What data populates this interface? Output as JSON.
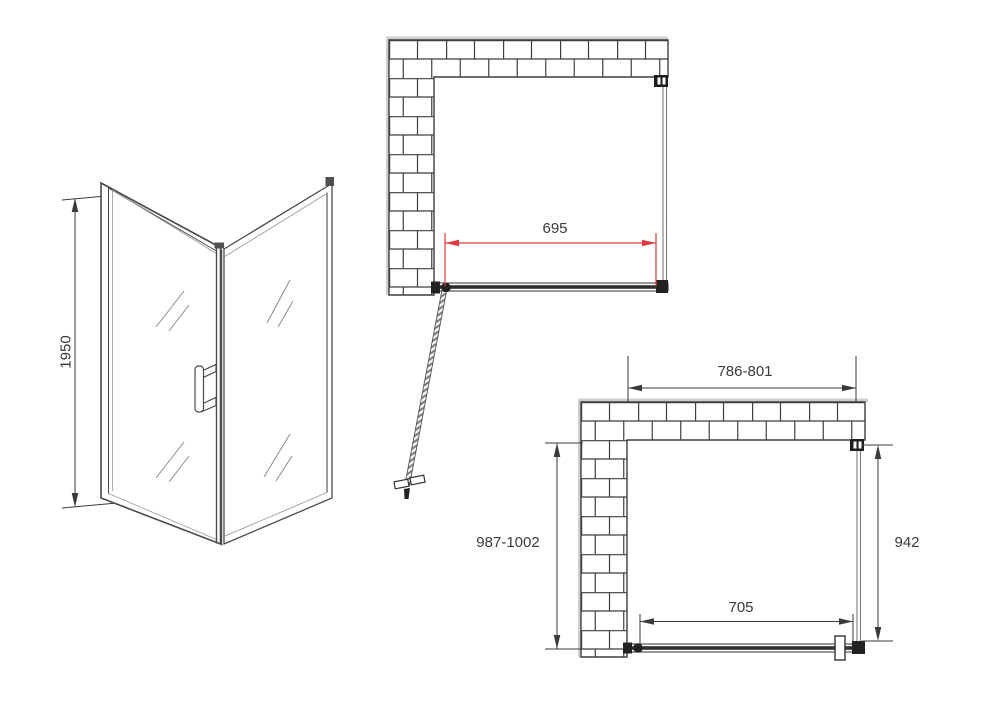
{
  "diagram": {
    "type": "shower-enclosure-technical-drawing",
    "isometric_view": {
      "height_label": "1950"
    },
    "top_plan_view": {
      "door_width_label": "695"
    },
    "front_plan_view": {
      "overall_width_label": "786-801",
      "overall_depth_label": "987-1002",
      "side_panel_label": "942",
      "door_glass_label": "705"
    }
  },
  "colors": {
    "dimension_red": "#e03a3e",
    "line_dark": "#3a3a3a",
    "line_gray": "#8a8a8a",
    "wall_edge_gray": "#cfcfcf",
    "background": "#ffffff"
  }
}
